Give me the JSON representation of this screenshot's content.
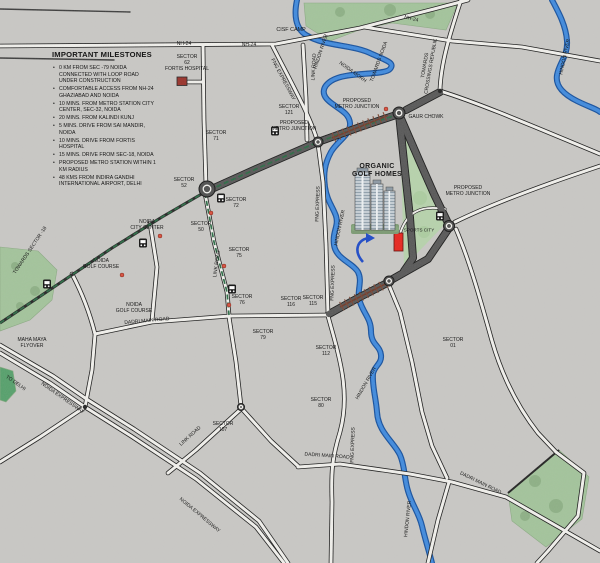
{
  "milestones": {
    "title": "IMPORTANT MILESTONES",
    "items": [
      "0 KM FROM SEC -79 NOIDA CONNECTED WITH LOOP ROAD UNDER CONSTRUCTION",
      "COMFORTABLE ACCESS FROM NH-24 GHAZIABAD AND NOIDA",
      "10 MINS. FROM METRO STATION CITY CENTER, SEC-32, NOIDA",
      "20 MINS. FROM KALINDI KUNJ",
      "5 MINS. DRIVE FROM SAI MANDIR, NOIDA",
      "10 MINS. DRIVE FROM FORTIS HOSPITAL",
      "15 MINS. DRIVE FROM SEC-18, NOIDA",
      "PROPOSED METRO STATION WITHIN 1 KM RADIUS",
      "48 KMS FROM INDIRA GANDHI INTERNATIONAL AIRPORT, DELHI"
    ]
  },
  "labels": {
    "cisf_camp": "CISF CAMP",
    "nh24": "NH-24",
    "sector_62_fortis": "SECTOR\n62\nFORTIS HOSPITAL",
    "link_road": "LINK ROAD",
    "hindon_river": "HINDON RIVER",
    "sector_121": "SECTOR\n121",
    "noida_morh": "NOIDA MORH",
    "towards_noida": "TOWARDS NOIDA",
    "towards_crossings_republik": "TOWARDS\nCROSSINGS REPUBLIK",
    "gaur_chowk": "GAUR CHOWK",
    "proposed_metro_junction": "PROPOSED\nMETRO JUNCTION",
    "sector_71": "SECTOR\n71",
    "sector_52": "SECTOR\n52",
    "sector_72": "SECTOR\n72",
    "sector_50": "SECTOR\n50",
    "noida_city_center": "NOIDA\nCITY CENTER",
    "sector_75": "SECTOR\n75",
    "sector_76": "SECTOR\n76",
    "noida_golf_course": "NOIDA\nGOLF COURSE",
    "dadri_main_road": "DADRI MAIN ROAD",
    "towards_sector_18": "TOWARDS SECTOR -18",
    "maha_maya_flyover": "MAHA MAYA\nFLYOVER",
    "to_delhi": "TO DELHI",
    "noida_expressway": "NOIDA EXPRESSWAY",
    "fng_expressway": "FNG EXPRESSWAY",
    "fng_express": "FNG EXPRESS",
    "sector_107": "SECTOR\n107",
    "sector_116": "SECTOR\n116",
    "sector_115": "SECTOR\n115",
    "sector_79": "SECTOR\n79",
    "sector_112": "SECTOR\n112",
    "sector_80": "SECTOR\n80",
    "sector_01": "SECTOR\n01",
    "organic_golf_homes": "ORGANIC\nGOLF HOMES",
    "sports_city": "SPORTS CITY"
  },
  "colors": {
    "river": "#3f8ade",
    "metro_line": "#2a6b44",
    "project_marker": "#e8241c",
    "fortis_marker": "#993129",
    "dark_road": "#575757",
    "green_area": "#a3c49b",
    "paper": "#c9c8c5"
  }
}
